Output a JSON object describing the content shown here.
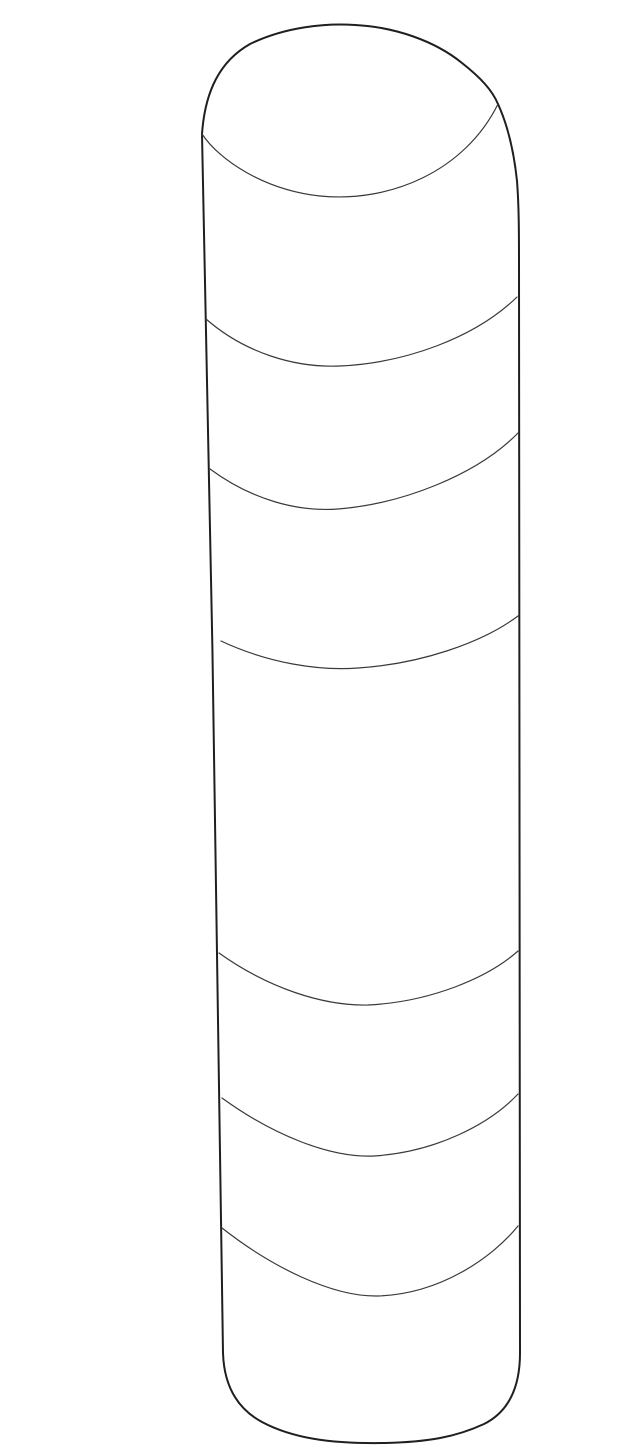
{
  "page": {
    "background_color": "#ffffff"
  },
  "diagram": {
    "name": "cylindrical-part-line-drawing",
    "description": "Black-and-white parts-catalog line drawing of a tall cylinder with rounded top and bottom, shown in slight perspective, with a tilted top face edge and six curved contour seam lines across the body",
    "viewbox": "0 0 640 1434",
    "style": {
      "outline_color": "#1f1f1f",
      "contour_color": "#3a3a3a",
      "outline_width": "2",
      "contour_width": "1.2"
    },
    "paths": {
      "outline": "M 162,118 C 165,75 180,45 210,28 C 245,11 285,7 315,9 C 355,11 395,25 422,47 C 441,62 452,74 458,88 C 468,110 474,136 477,165 C 479,190 479,220 479,250 L 480,1337 C 480,1372 468,1396 444,1408 C 416,1421 388,1426 345,1427 C 290,1428 252,1422 222,1406 C 196,1392 184,1368 183,1337 C 181,1150 171,480 162,118 Z",
      "top_face": "M 162,118 C 180,145 225,174 280,180 C 350,187 425,155 458,88",
      "contours": [
        "M 166,303 C 205,337 255,352 300,350 C 365,347 435,322 477,281",
        "M 170,453 C 212,484 258,496 298,493 C 362,488 437,459 478,417",
        "M 181,625 C 228,647 278,655 318,652 C 380,648 442,627 478,600",
        "M 179,937 C 228,972 283,990 328,989 C 390,986 448,962 478,935",
        "M 182,1082 C 233,1119 290,1142 334,1140 C 396,1136 450,1108 478,1078",
        "M 182,1212 C 233,1252 293,1281 338,1280 C 400,1278 452,1242 478,1210"
      ]
    }
  }
}
